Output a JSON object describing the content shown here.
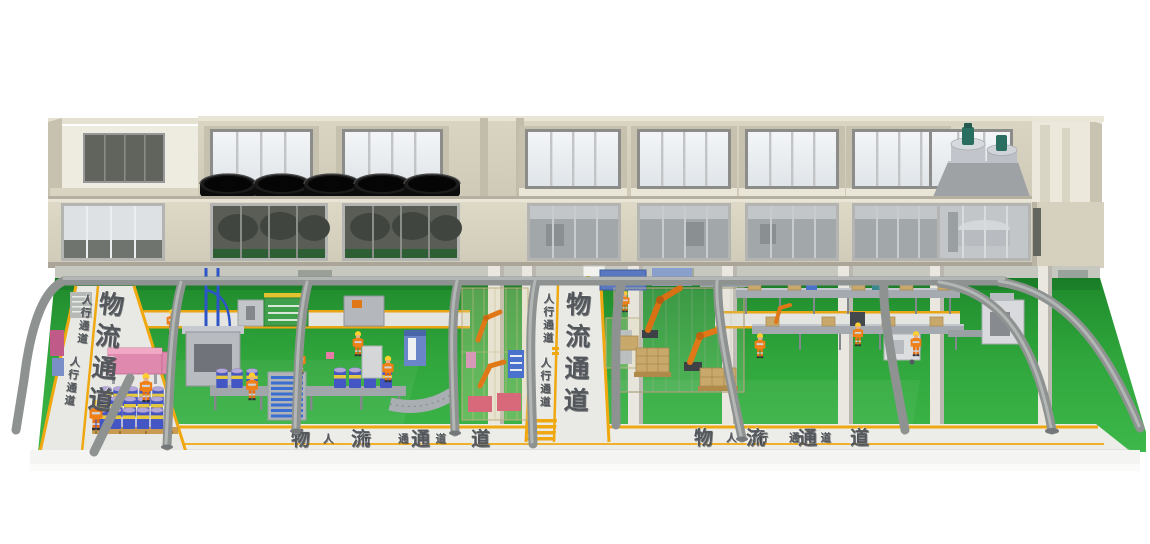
{
  "walkways": {
    "left_vertical": {
      "logistics_label": "物流通道",
      "pedestrian_label_1": "人行通道",
      "pedestrian_label_2": "人行通道"
    },
    "center_vertical": {
      "logistics_label": "物流通道",
      "pedestrian_label_1": "人行通道",
      "pedestrian_label_2": "人行通道"
    },
    "bottom_left_segment": {
      "logistics_label": "物流通道",
      "pedestrian_label": "人行通道"
    },
    "bottom_right_segment": {
      "logistics_label": "物流通道",
      "pedestrian_label": "人行通道"
    }
  },
  "scene": {
    "black_vats_count": 5,
    "building_floors": 2
  },
  "colors": {
    "background": "#ffffff",
    "building_wall": "#d6d1bf",
    "window_glass_bright": "#eef0f3",
    "window_glass_dark": "#5c605a",
    "floor_green": "#2ea13a",
    "aisle_surface": "#e9e9e5",
    "aisle_stripe_yellow": "#f0a810",
    "aisle_text_gray": "#54585c",
    "canopy_frame_gray": "#9a9e9e",
    "worker_suit_orange": "#f08018",
    "helmet_yellow": "#ffcf2e",
    "drum_blue": "#4456c4",
    "drum_lid_purple": "#b3a6d9",
    "drum_band_yellow": "#e6c83e",
    "robot_orange": "#e07818",
    "carton_tan": "#c9a96b",
    "machine_pink": "#e589ae",
    "pipe_blue": "#2e55c8",
    "vat_black": "#141414",
    "tank_steel": "#c4c8cc",
    "tank_motor_green": "#2a6e62"
  }
}
